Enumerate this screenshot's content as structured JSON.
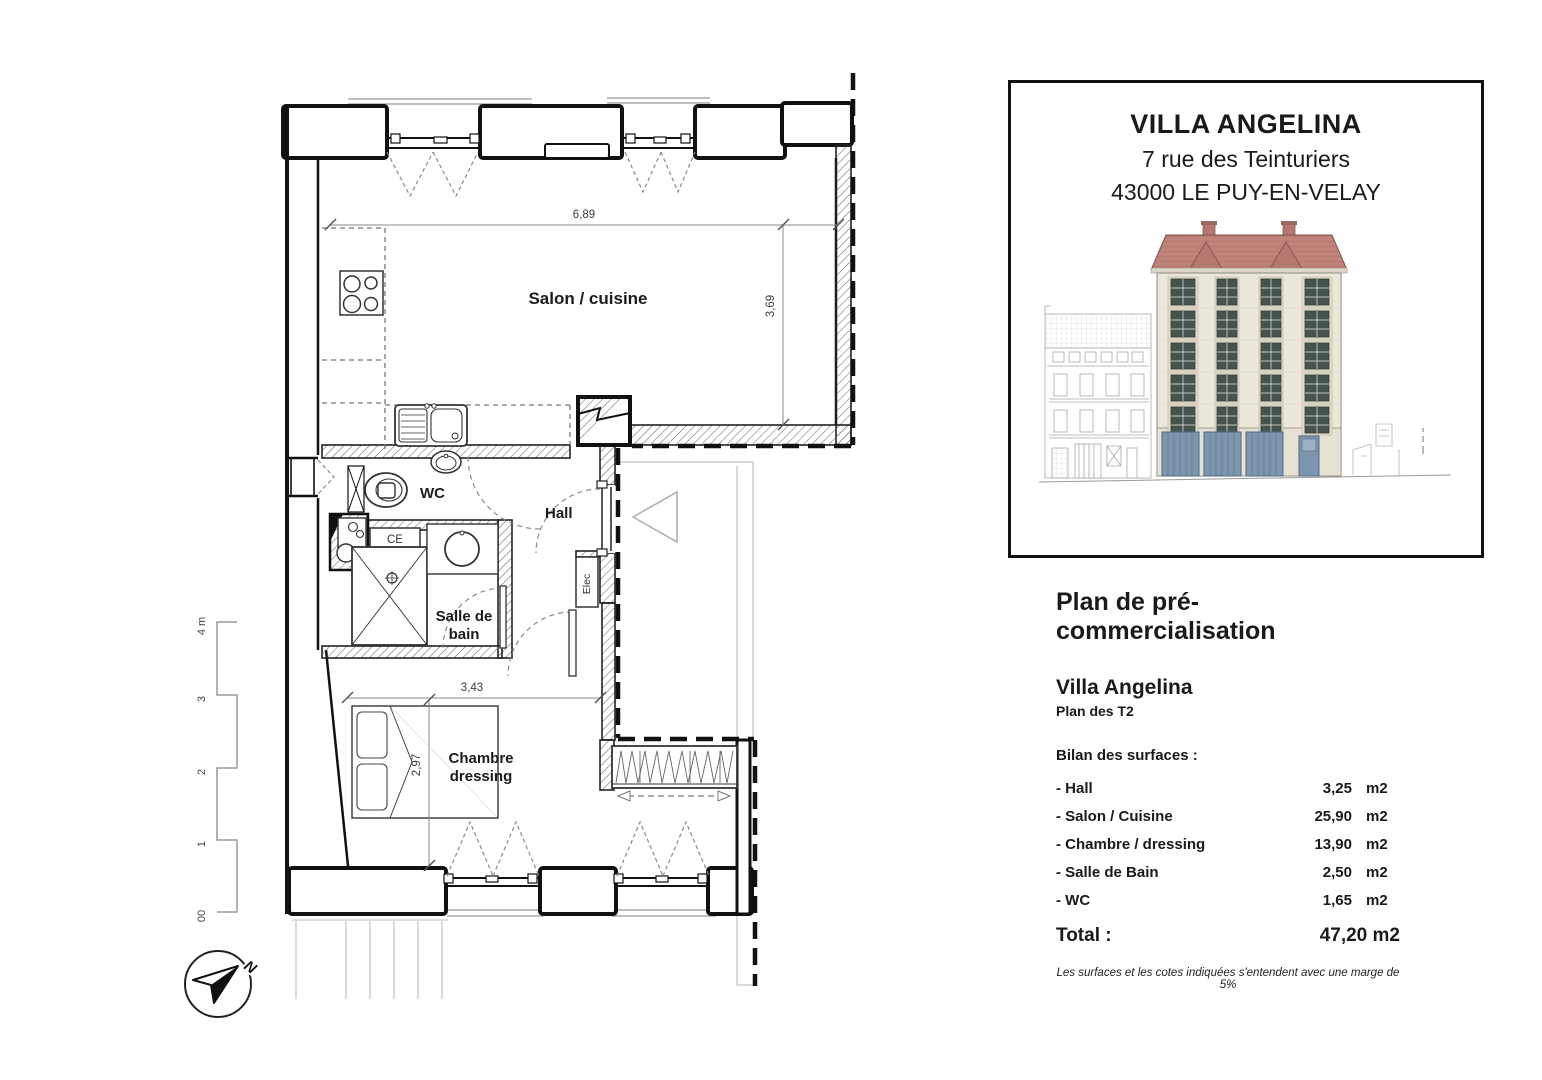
{
  "plan": {
    "rooms": {
      "salon": "Salon / cuisine",
      "wc": "WC",
      "hall": "Hall",
      "ce": "CE",
      "elec": "Elec",
      "sdb_line1": "Salle de",
      "sdb_line2": "bain",
      "chambre_line1": "Chambre",
      "chambre_line2": "dressing"
    },
    "dimensions": {
      "salon_width": "6,89",
      "salon_height": "3,69",
      "chambre_width": "3,43",
      "chambre_height": "2,97"
    },
    "scale_bar": {
      "labels": [
        "4 m",
        "3",
        "2",
        "1",
        "00"
      ]
    },
    "compass_north": "N"
  },
  "card": {
    "title": "VILLA ANGELINA",
    "address_line1": "7 rue des Teinturiers",
    "address_line2": "43000 LE PUY-EN-VELAY"
  },
  "details": {
    "heading": "Plan de pré-commercialisation",
    "subheading": "Villa Angelina",
    "plan_type": "Plan des T2",
    "surfaces_title": "Bilan des surfaces :",
    "rows": [
      {
        "label": "- Hall",
        "value": "3,25",
        "unit": "m2"
      },
      {
        "label": "- Salon / Cuisine",
        "value": "25,90",
        "unit": "m2"
      },
      {
        "label": "- Chambre / dressing",
        "value": "13,90",
        "unit": "m2"
      },
      {
        "label": "- Salle de Bain",
        "value": "2,50",
        "unit": "m2"
      },
      {
        "label": "- WC",
        "value": "1,65",
        "unit": "m2"
      }
    ],
    "total_label": "Total :",
    "total_value": "47,20 m2",
    "footnote": "Les surfaces et les cotes indiquées s'entendent avec une marge de 5%"
  },
  "colors": {
    "wall_ink": "#111111",
    "facade": "#ece7db",
    "roof": "#c08279",
    "window_glass": "#46544d",
    "door_blue": "#7e96ad",
    "sketch_gray": "#b5b5b5"
  }
}
